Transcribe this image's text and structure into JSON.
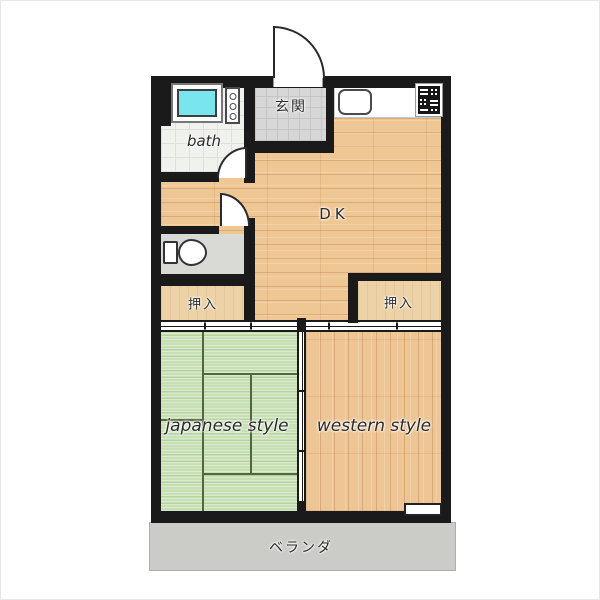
{
  "plan": {
    "rooms": {
      "genkan": {
        "label": "玄関"
      },
      "bath": {
        "label": "bath"
      },
      "dk": {
        "label": "DK"
      },
      "closet_left": {
        "label": "押入"
      },
      "closet_right": {
        "label": "押入"
      },
      "japanese": {
        "label": "japanese style"
      },
      "western": {
        "label": "western style"
      },
      "veranda": {
        "label": "ベランダ"
      }
    },
    "colors": {
      "wall": "#1a1a1a",
      "wood_floor": "#efc795",
      "tatami": "#c6dfb3",
      "entrance_tile": "#d7d7d7",
      "bath_water": "#79e6ee",
      "veranda": "#cbcbc7"
    }
  }
}
